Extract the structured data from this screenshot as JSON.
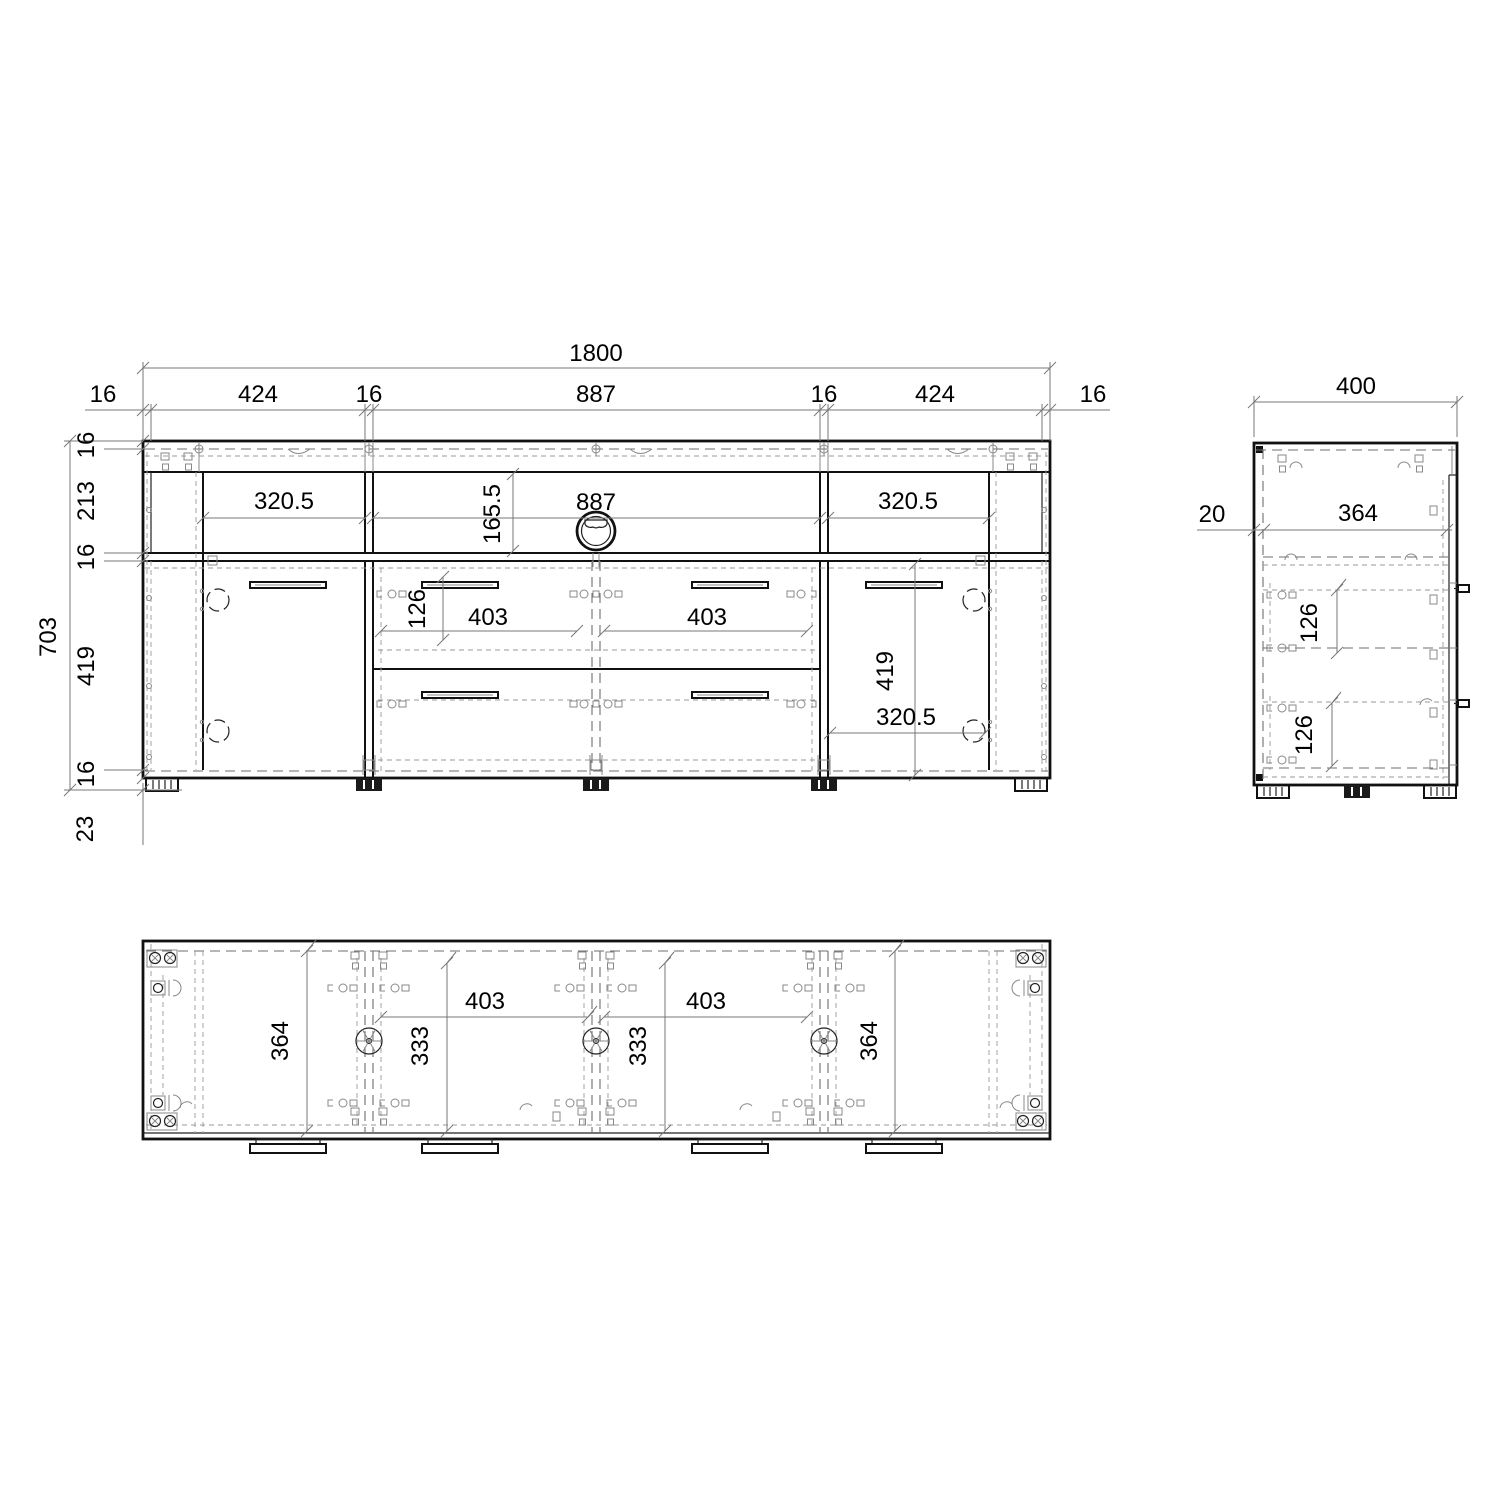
{
  "drawing": {
    "front": {
      "overall_width": "1800",
      "width_segments": [
        "16",
        "424",
        "16",
        "887",
        "16",
        "424",
        "16"
      ],
      "overall_height": "703",
      "height_segments": [
        "16",
        "213",
        "16",
        "419",
        "16"
      ],
      "plinth_height": "23",
      "top_left_compartment_width": "320.5",
      "open_compartment_height": "165.5",
      "open_compartment_width": "887",
      "top_right_compartment_width": "320.5",
      "drawer_front_height": "126",
      "drawer_width_left": "403",
      "drawer_width_right": "403",
      "door_opening_height": "419",
      "door_width": "320.5"
    },
    "side": {
      "overall_depth": "400",
      "back_panel_offset": "20",
      "inner_depth": "364",
      "upper_drawer_height": "126",
      "lower_drawer_height": "126"
    },
    "bottom": {
      "side_compartment_depth_left": "364",
      "drawer_opening_width_left": "403",
      "drawer_depth_left": "333",
      "drawer_opening_width_right": "403",
      "drawer_depth_right": "333",
      "side_compartment_depth_right": "364"
    }
  }
}
